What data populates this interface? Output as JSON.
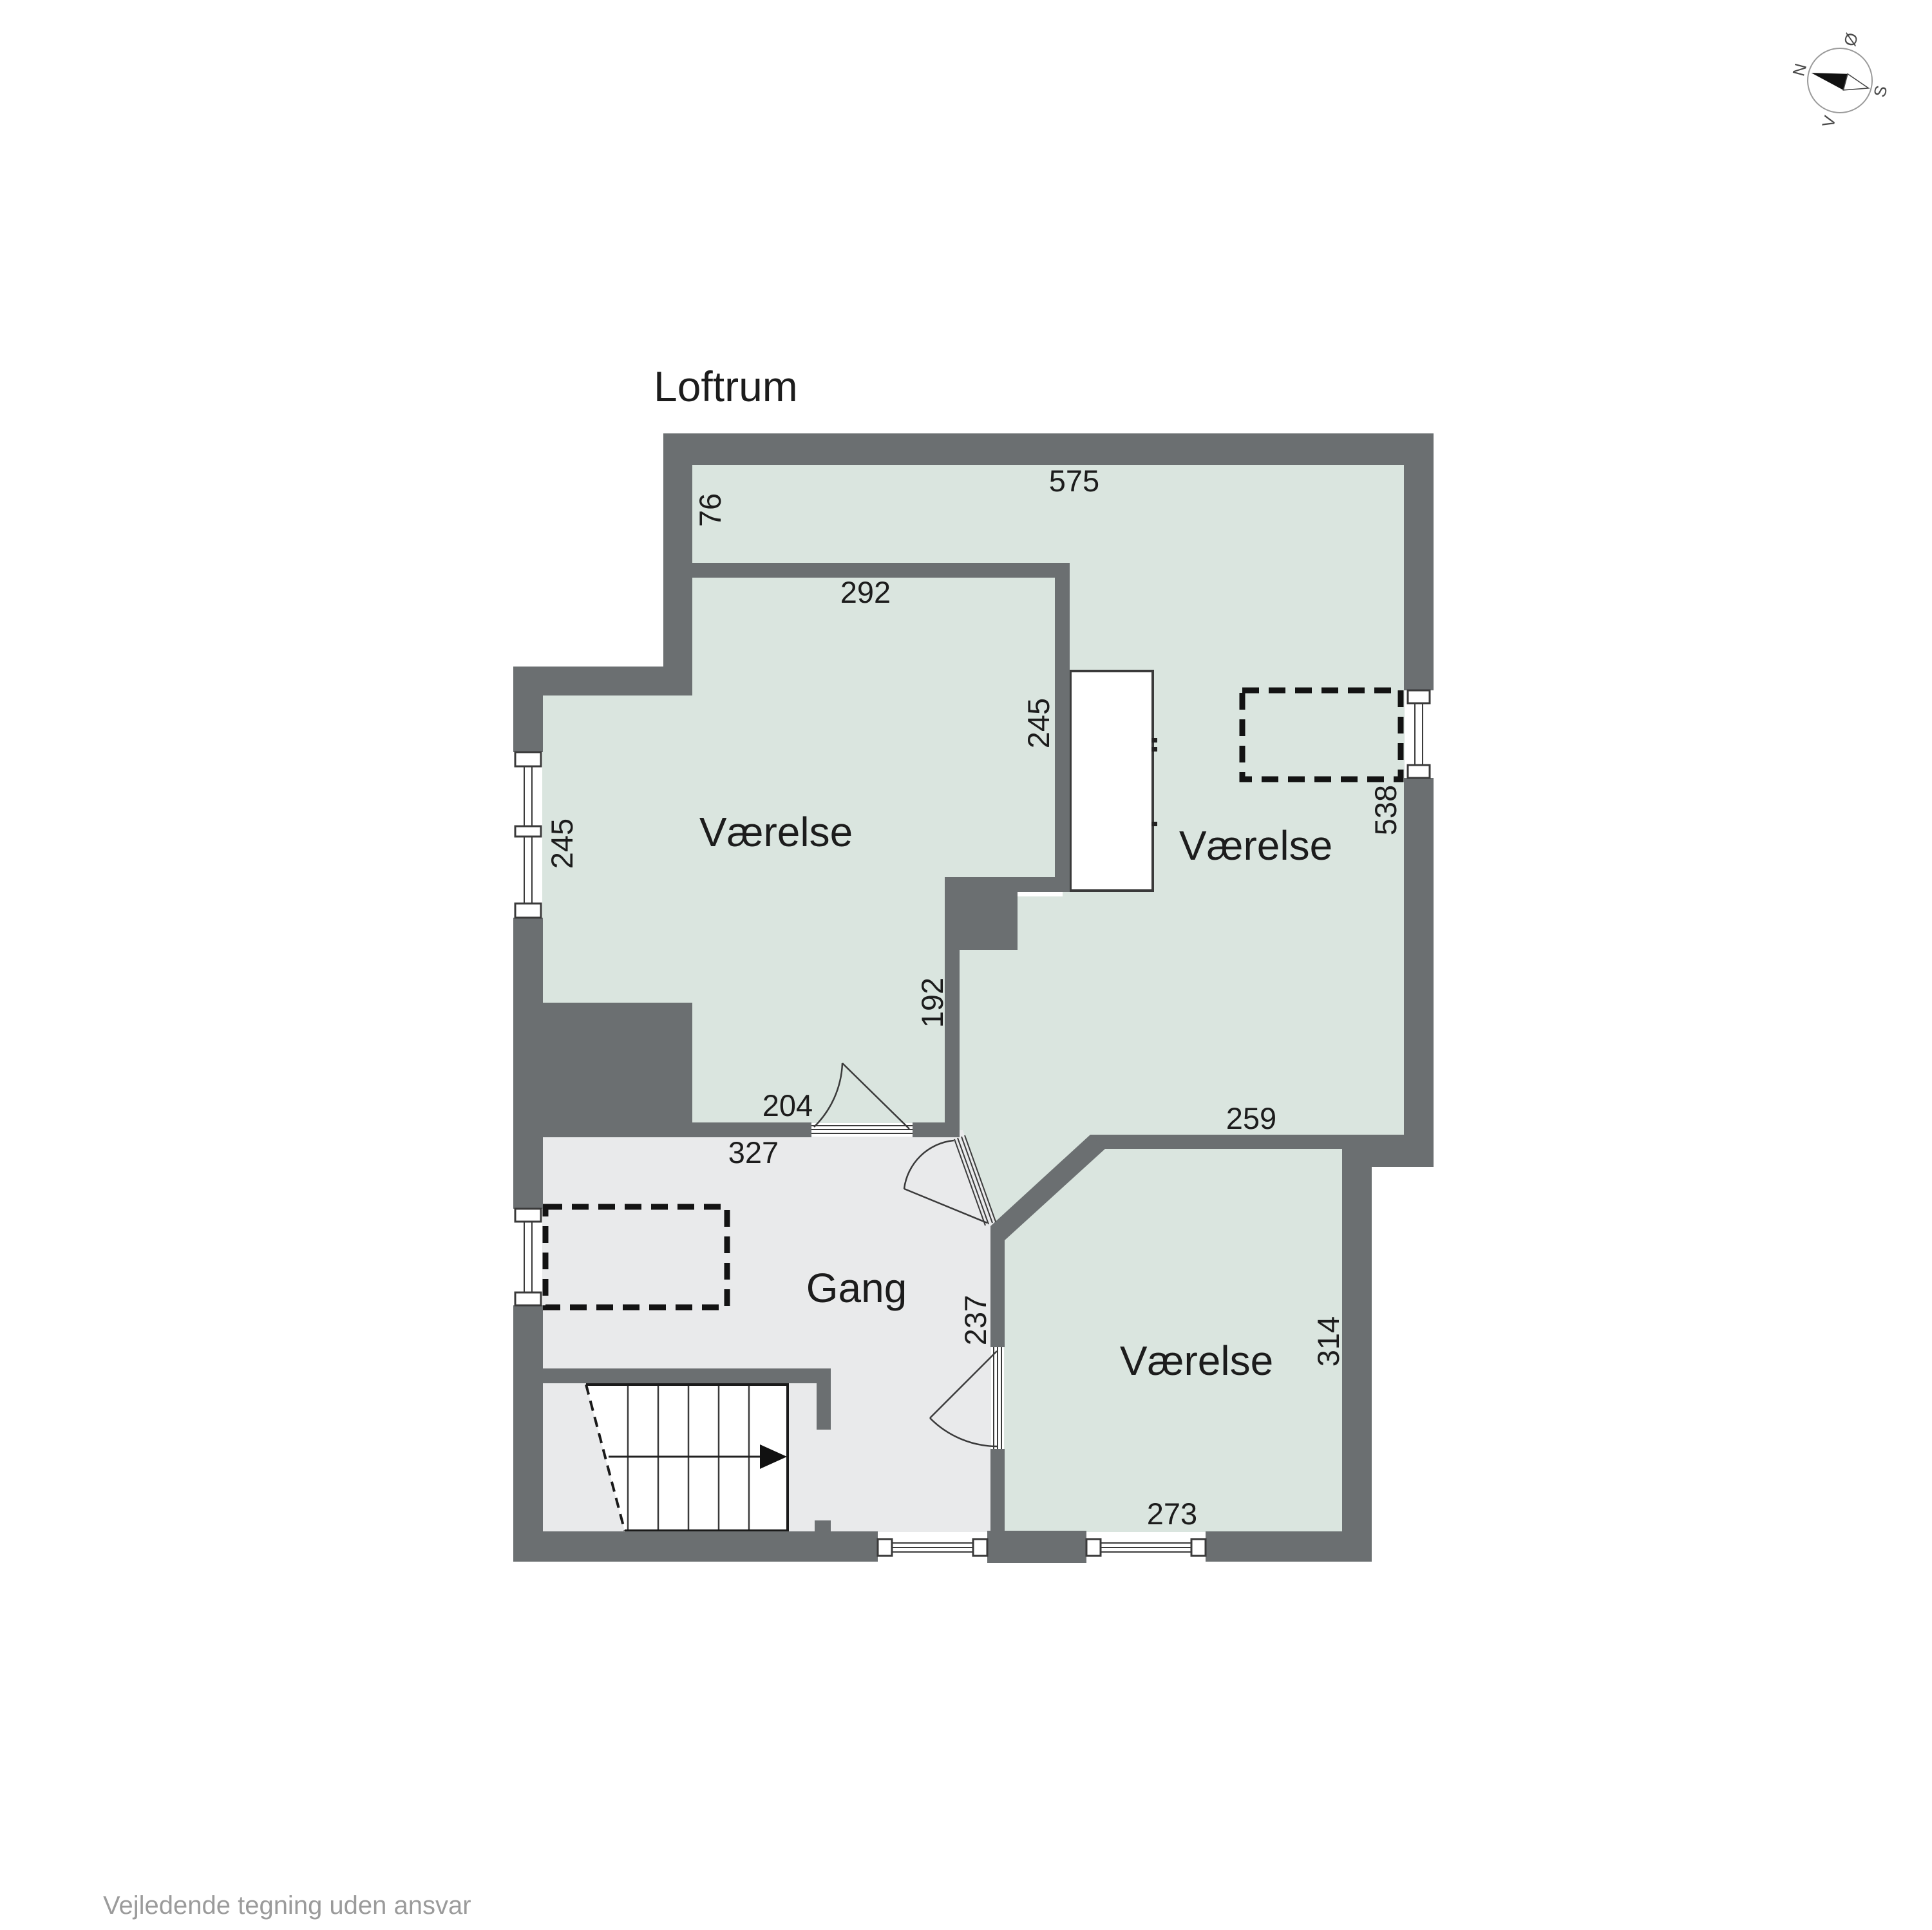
{
  "title": "Loftrum",
  "footer": "Vejledende tegning uden ansvar",
  "colors": {
    "wall": "#6b6f71",
    "room": "#dae5df",
    "hall": "#e9eaeb",
    "ink": "#1c1c1c",
    "muted": "#9b9b9b",
    "line": "#3a3a3a"
  },
  "rooms": [
    {
      "label": "Værelse"
    },
    {
      "label": "Værelse"
    },
    {
      "label": "Gang"
    },
    {
      "label": "Værelse"
    }
  ],
  "dims": [
    {
      "text": "575"
    },
    {
      "text": "76"
    },
    {
      "text": "292"
    },
    {
      "text": "245"
    },
    {
      "text": "538"
    },
    {
      "text": "245"
    },
    {
      "text": "192"
    },
    {
      "text": "204"
    },
    {
      "text": "327"
    },
    {
      "text": "259"
    },
    {
      "text": "237"
    },
    {
      "text": "314"
    },
    {
      "text": "273"
    }
  ],
  "compass": {
    "letters": {
      "n": "N",
      "e": "Ø",
      "s": "S",
      "w": "V"
    }
  }
}
